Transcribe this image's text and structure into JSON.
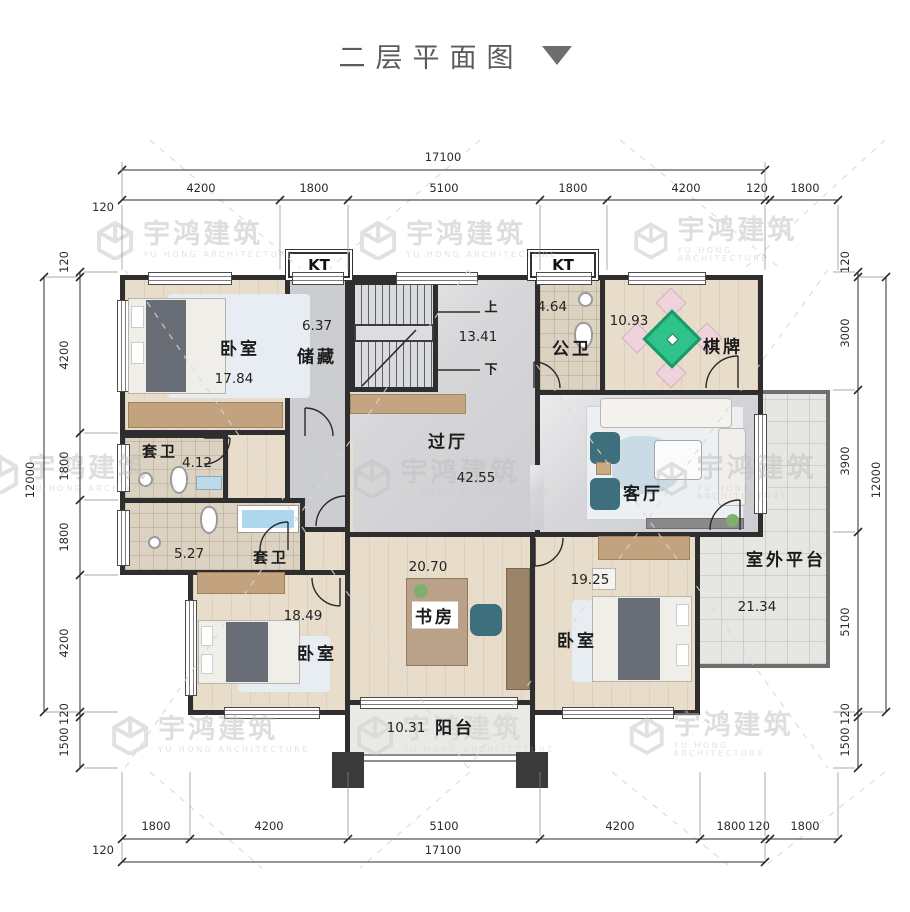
{
  "title": {
    "text": "二层平面图"
  },
  "watermark": {
    "name": "宇鸿建筑",
    "subtitle": "YU HONG ARCHITECTURE"
  },
  "rooms": {
    "bedroom_tl": {
      "label": "卧室",
      "area": "17.84"
    },
    "storage": {
      "label": "储藏",
      "area": "6.37"
    },
    "stairs": {
      "up": "上",
      "down": "下",
      "area": "13.41"
    },
    "public_bath": {
      "label": "公卫",
      "area": "4.64"
    },
    "chess": {
      "label": "棋牌",
      "area": "10.93"
    },
    "ensuite_1": {
      "label": "套卫",
      "area": "4.12"
    },
    "hallway": {
      "label": "过厅",
      "area": "42.55"
    },
    "living": {
      "label": "客厅"
    },
    "ensuite_2": {
      "label": "套卫",
      "area": "5.27"
    },
    "bedroom_bl": {
      "label": "卧室",
      "area": "18.49"
    },
    "study": {
      "label": "书房",
      "area": "20.70"
    },
    "bedroom_br": {
      "label": "卧室",
      "area": "19.25"
    },
    "balcony": {
      "label": "阳台",
      "area": "10.31"
    },
    "terrace": {
      "label": "室外平台",
      "area": "21.34"
    },
    "kt_left": {
      "label": "KT"
    },
    "kt_right": {
      "label": "KT"
    }
  },
  "dimensions": {
    "top": {
      "total": "17100",
      "wall": "120",
      "segments": [
        "4200",
        "1800",
        "5100",
        "1800",
        "4200",
        "120",
        "1800"
      ]
    },
    "bottom": {
      "total": "17100",
      "wall": "120",
      "segments": [
        "1800",
        "4200",
        "5100",
        "4200",
        "1800",
        "120",
        "1800"
      ]
    },
    "left": {
      "total": "12000",
      "segments": [
        "120",
        "4200",
        "1800",
        "1800",
        "4200",
        "120",
        "1500"
      ]
    },
    "right": {
      "total": "12000",
      "segments": [
        "120",
        "3000",
        "3900",
        "5100",
        "120",
        "1500"
      ]
    }
  },
  "colors": {
    "wall": "#2e2e2e",
    "accent_green": "#2fc28b",
    "accent_teal": "#3e6f7d",
    "water_blue": "#aed7ee"
  }
}
